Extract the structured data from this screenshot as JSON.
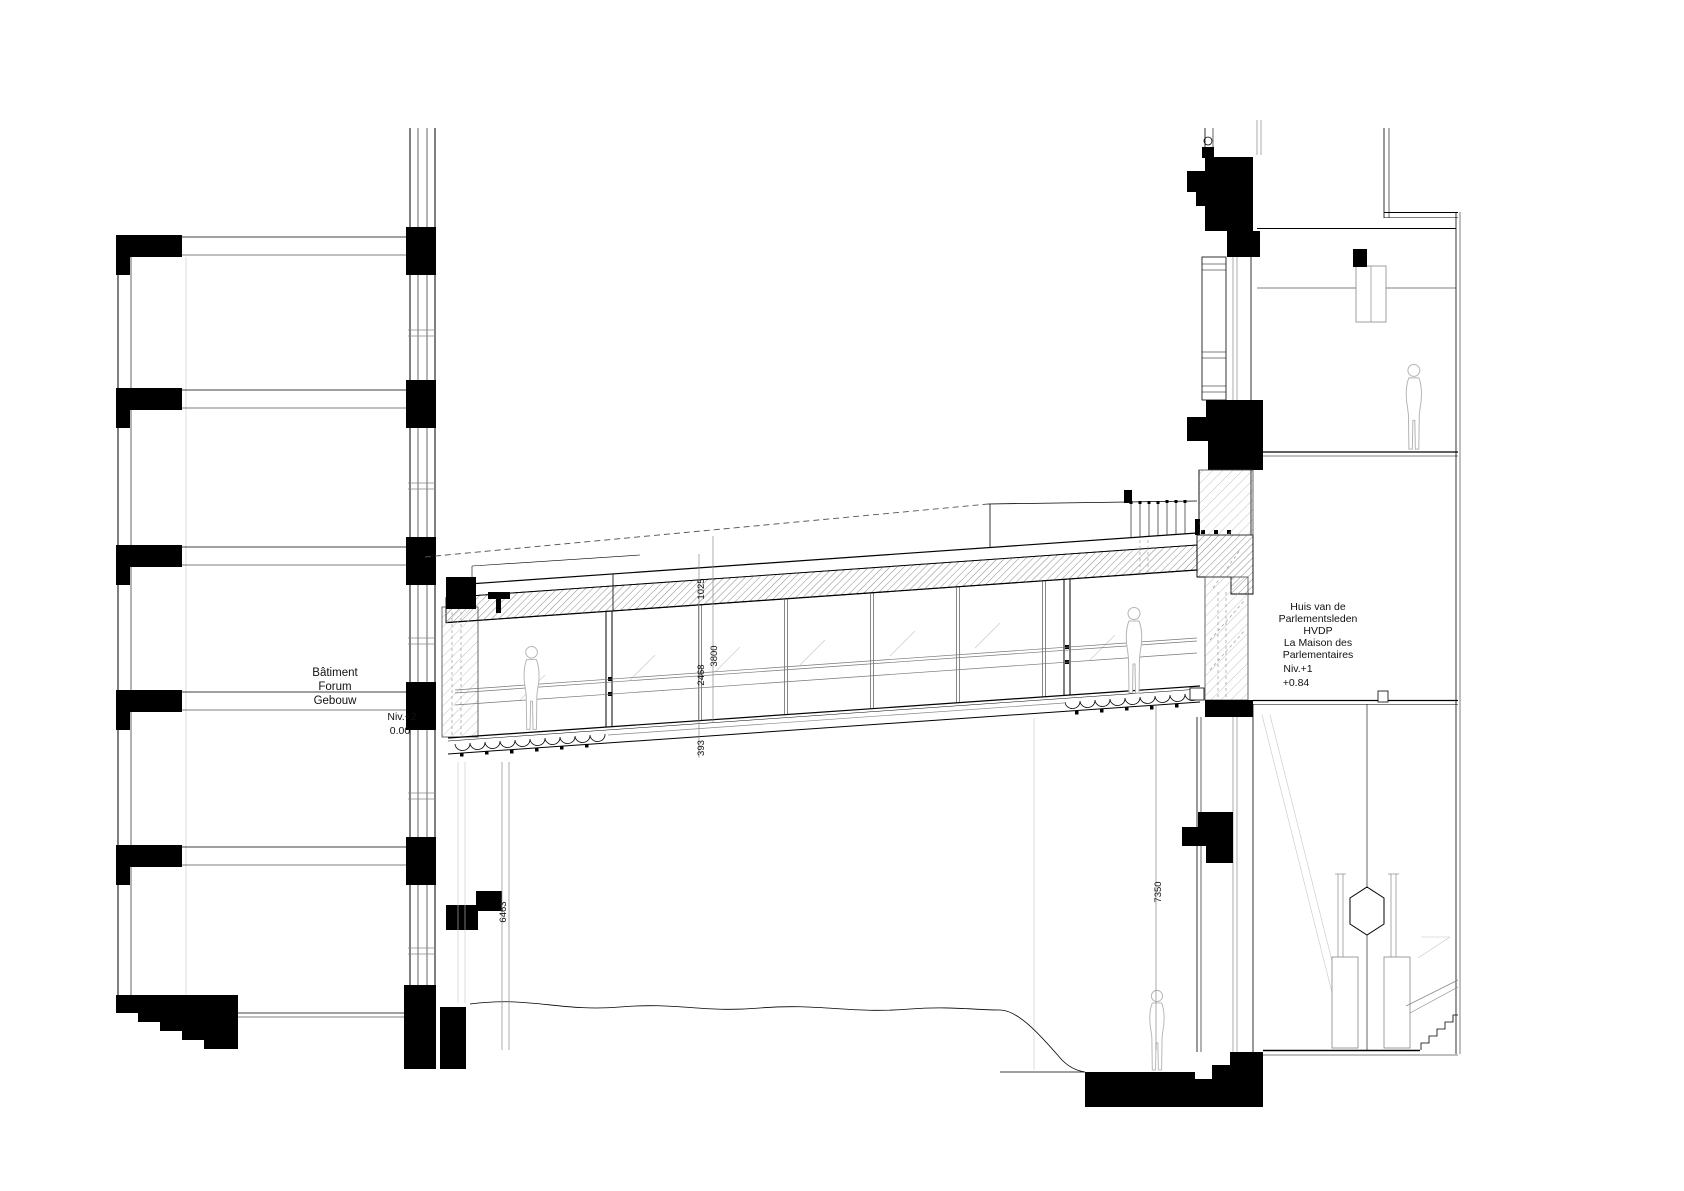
{
  "left_building": {
    "line1": "Bâtiment",
    "line2": "Forum",
    "line3": "Gebouw",
    "level": "Niv.+2",
    "elevation": "0.00"
  },
  "right_building": {
    "line1": "Huis van de",
    "line2": "Parlementsleden",
    "line3": "HVDP",
    "line4": "La Maison des",
    "line5": "Parlementaires",
    "level": "Niv.+1",
    "elevation": "+0.84"
  },
  "dimensions": {
    "bridge_roof": "1025",
    "bridge_total": "3800",
    "bridge_glass": "2468",
    "bridge_floor": "393",
    "left_height": "6463",
    "right_height": "7350"
  },
  "colors": {
    "ink": "#000000",
    "light_line": "#888888",
    "figure_outline": "#b4b4b4",
    "background": "#ffffff"
  }
}
